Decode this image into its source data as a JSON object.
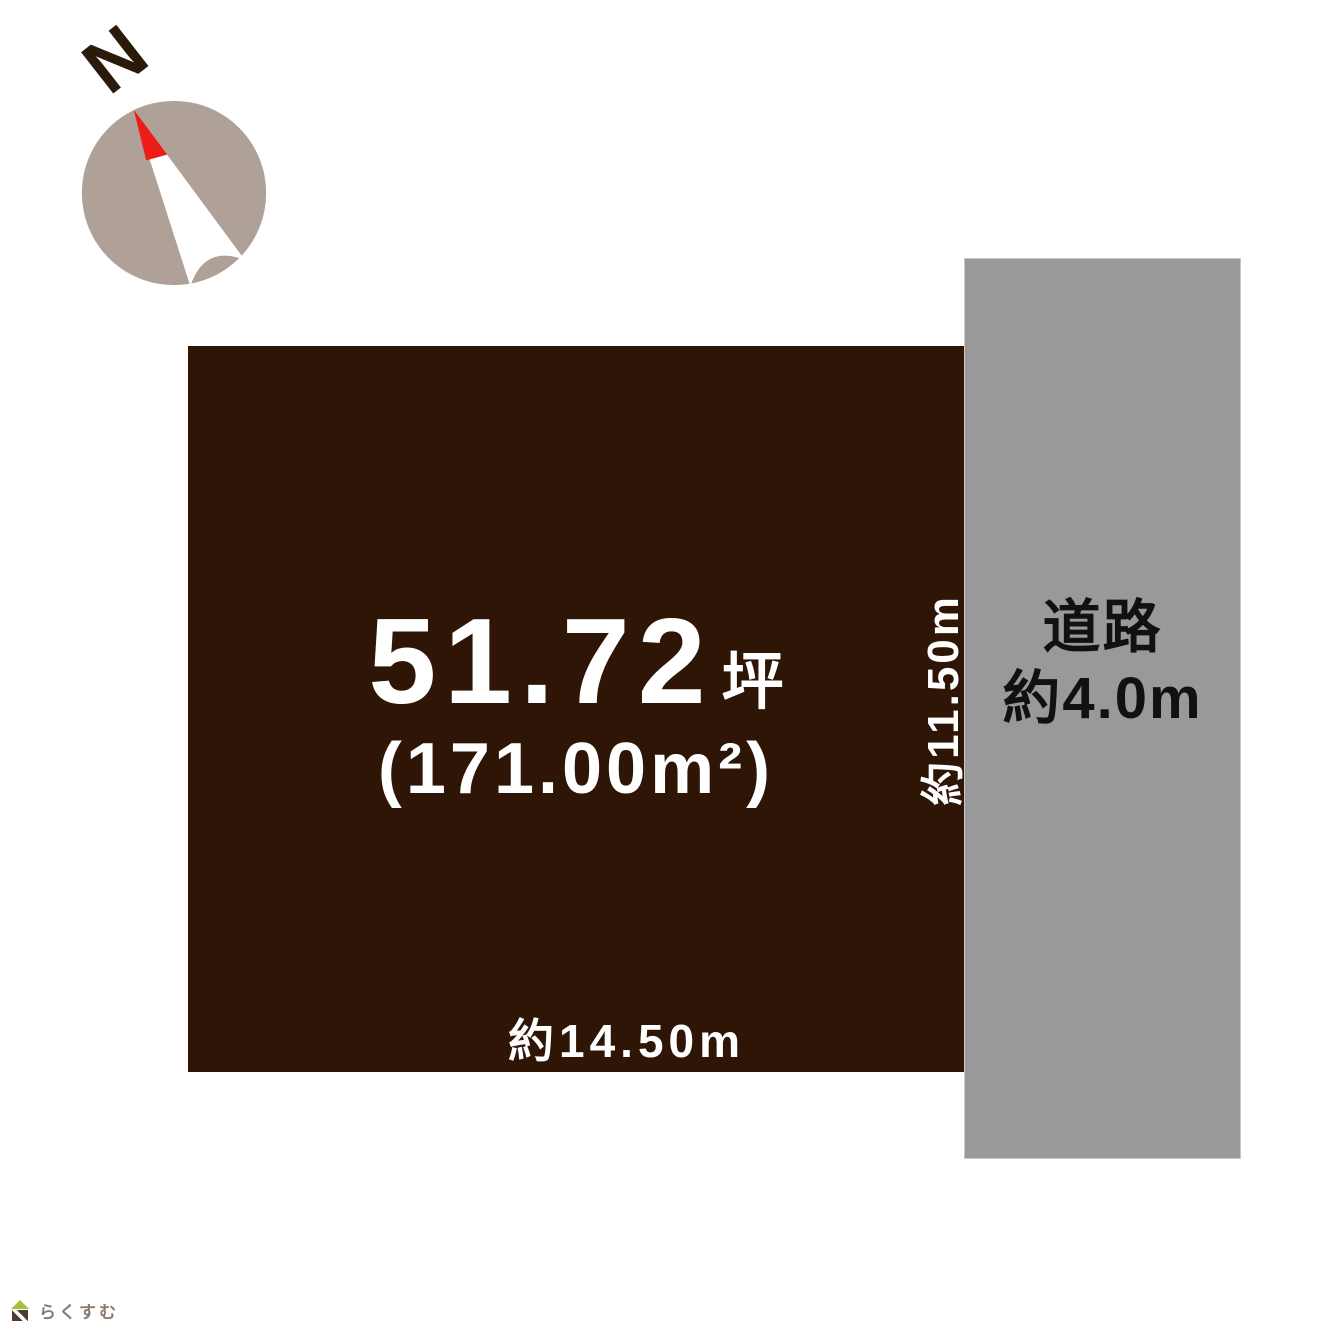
{
  "compass": {
    "north_label": "N"
  },
  "plot": {
    "area_tsubo": "51.72",
    "area_tsubo_unit": "坪",
    "area_m2": "(171.00m²)",
    "bottom_dimension": "約14.50m",
    "side_dimension": "約11.50m"
  },
  "road": {
    "name": "道路",
    "width": "約4.0m"
  },
  "logo": {
    "brand": "らくすむ"
  },
  "colors": {
    "plot_fill": "#2e1505",
    "plot_text": "#ffffff",
    "road_fill": "#999999",
    "road_border": "#c8c8c8",
    "road_text": "#111111",
    "compass_circle": "#b0a198",
    "compass_needle": "#ffffff",
    "compass_needle_tip": "#ee1c17",
    "north_letter": "#2a1a0a",
    "logo_roof": "#a9bd3c",
    "logo_body": "#4e3d33",
    "logo_text": "#8b7a6e"
  }
}
